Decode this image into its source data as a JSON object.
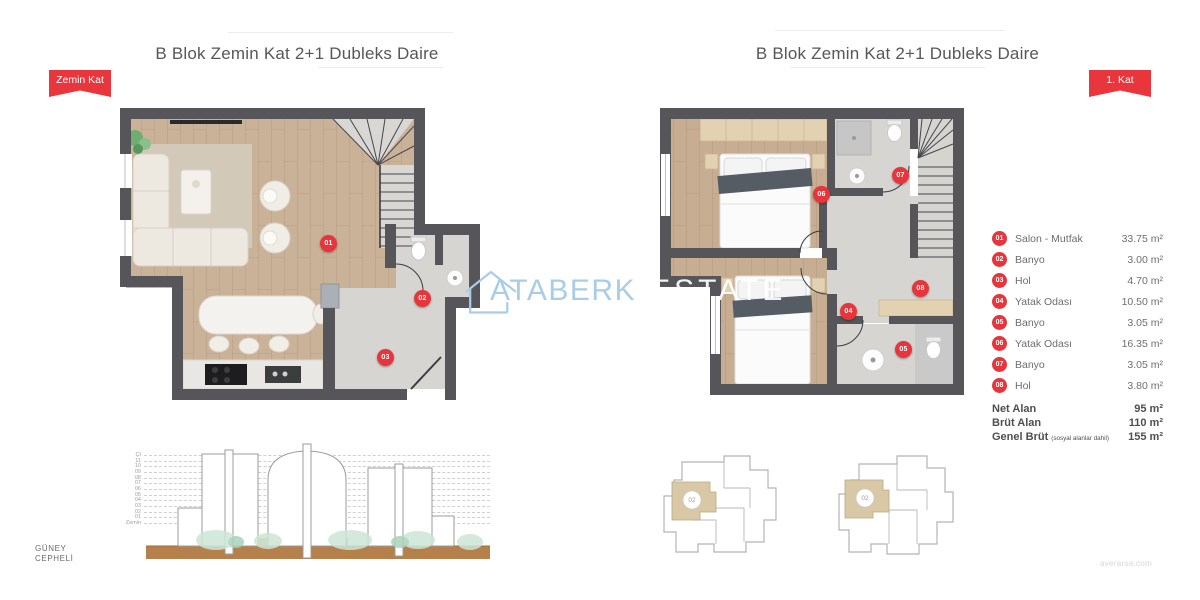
{
  "page": {
    "watermark_brand": "ATABERK",
    "watermark_suffix": "ESTATE",
    "footer_url": "averarsa.com"
  },
  "left_panel": {
    "title": "B Blok Zemin Kat 2+1 Dubleks Daire",
    "ribbon": "Zemin Kat",
    "markers": [
      {
        "no": "01"
      },
      {
        "no": "02"
      },
      {
        "no": "03"
      }
    ]
  },
  "right_panel": {
    "title": "B Blok Zemin Kat 2+1 Dubleks Daire",
    "ribbon": "1. Kat",
    "markers": [
      {
        "no": "04"
      },
      {
        "no": "05"
      },
      {
        "no": "06"
      },
      {
        "no": "07"
      },
      {
        "no": "08"
      }
    ],
    "keyplan_unit": "02"
  },
  "legend": {
    "rows": [
      {
        "no": "01",
        "label": "Salon - Mutfak",
        "area": "33.75 m²"
      },
      {
        "no": "02",
        "label": "Banyo",
        "area": "3.00 m²"
      },
      {
        "no": "03",
        "label": "Hol",
        "area": "4.70 m²"
      },
      {
        "no": "04",
        "label": "Yatak Odası",
        "area": "10.50 m²"
      },
      {
        "no": "05",
        "label": "Banyo",
        "area": "3.05 m²"
      },
      {
        "no": "06",
        "label": "Yatak Odası",
        "area": "16.35 m²"
      },
      {
        "no": "07",
        "label": "Banyo",
        "area": "3.05 m²"
      },
      {
        "no": "08",
        "label": "Hol",
        "area": "3.80 m²"
      }
    ],
    "summary": [
      {
        "label": "Net Alan",
        "note": "",
        "value": "95 m²"
      },
      {
        "label": "Brüt Alan",
        "note": "",
        "value": "110 m²"
      },
      {
        "label": "Genel Brüt",
        "note": "(sosyal alanlar dahil)",
        "value": "155 m²"
      }
    ]
  },
  "elevation": {
    "facade_line1": "GÜNEY",
    "facade_line2": "CEPHELİ",
    "levels": [
      "Çt",
      "11",
      "10",
      "09",
      "08",
      "07",
      "06",
      "05",
      "04",
      "03",
      "02",
      "01",
      "Zemin"
    ]
  },
  "colors": {
    "accent_red": "#e8363c",
    "wall_gray": "#56565a",
    "wood_floor": "#cab299",
    "tile_floor": "#d7d5d2",
    "wardrobe_beige": "#e3d2b2",
    "watermark_blue": "#a9cde9",
    "ground_brown": "#b5804a"
  }
}
